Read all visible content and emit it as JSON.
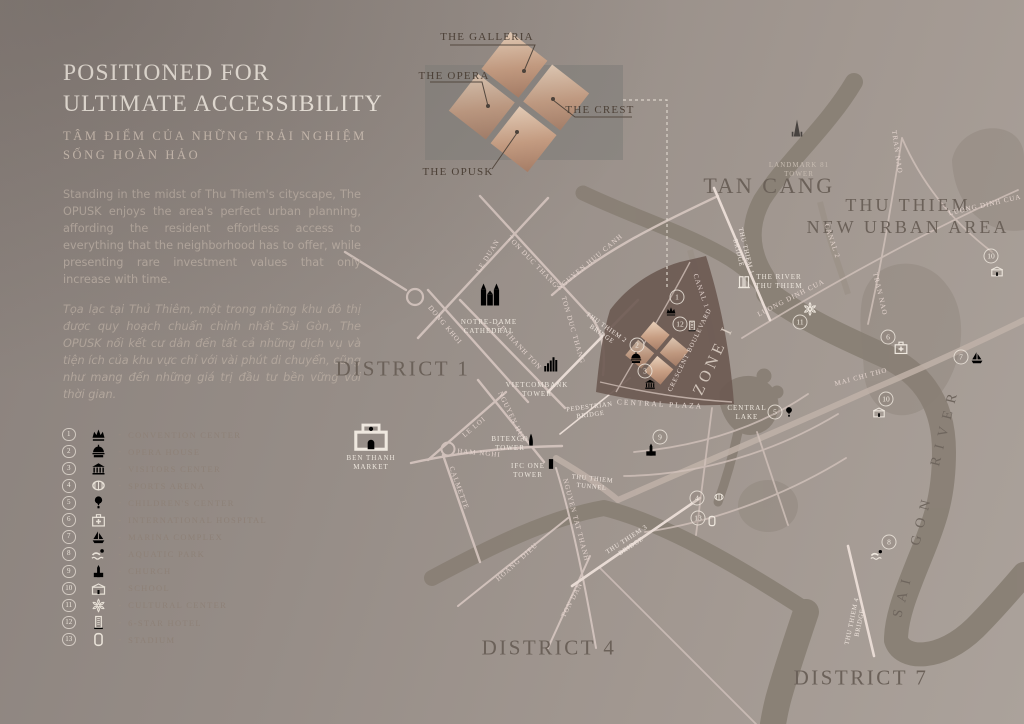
{
  "panel": {
    "title_line1": "POSITIONED FOR",
    "title_line2": "ULTIMATE ACCESSIBILITY",
    "subtitle_line1": "TÂM ĐIỂM CỦA NHỮNG TRẢI NGHIỆM",
    "subtitle_line2": "SỐNG HOÀN HẢO",
    "paragraph_en": "Standing in the midst of Thu Thiem's cityscape, The OPUSK enjoys the area's perfect urban planning, affording the resident effortless access to everything that the neighborhood has to offer, while presenting rare investment values that only increase with time.",
    "paragraph_vi": "Tọa lạc tại Thủ Thiêm, một trong những khu đô thị được quy hoạch chuẩn chỉnh nhất Sài Gòn, The OPUSK nối kết cư dân đến tất cả những dịch vụ và tiện ích của khu vực chỉ với vài phút di chuyển, cũng như mang đến những giá trị đầu tư bền vững với thời gian."
  },
  "inset": {
    "galleria": "THE GALLERIA",
    "opera": "THE OPERA",
    "crest": "THE CREST",
    "opusk": "THE OPUSK"
  },
  "legend": {
    "sep": "-",
    "items": [
      {
        "num": "1",
        "label": "CONVENTION CENTER"
      },
      {
        "num": "2",
        "label": "OPERA HOUSE"
      },
      {
        "num": "3",
        "label": "VISITORS CENTER"
      },
      {
        "num": "4",
        "label": "SPORTS ARENA"
      },
      {
        "num": "5",
        "label": "CHILDREN'S CENTER"
      },
      {
        "num": "6",
        "label": "INTERNATIONAL HOSPITAL"
      },
      {
        "num": "7",
        "label": "MARINA COMPLEX"
      },
      {
        "num": "8",
        "label": "AQUATIC PARK"
      },
      {
        "num": "9",
        "label": "CHURCH"
      },
      {
        "num": "10",
        "label": "SCHOOL"
      },
      {
        "num": "11",
        "label": "CULTURAL CENTER"
      },
      {
        "num": "12",
        "label": "6-STAR HOTEL"
      },
      {
        "num": "13",
        "label": "STADIUM"
      }
    ]
  },
  "map": {
    "districts": [
      "DISTRICT 1",
      "DISTRICT 4",
      "DISTRICT 7"
    ],
    "tan_cang": "TAN CANG",
    "thu_thiem_line1": "THU THIEM",
    "thu_thiem_line2": "NEW URBAN AREA",
    "sai_gon_river": "SAI GON RIVER",
    "zone": "ZONE I",
    "crescent_blvd": "CRESCENT BOULEVARD",
    "central_plaza": "CENTRAL PLAZA",
    "streets": [
      "LE DUAN",
      "TON DUC THANG",
      "NGUYEN HUU CANH",
      "DONG KHOI",
      "LE THANH TON",
      "TON DUC THANG",
      "NGUYEN HUE",
      "LE LOI",
      "HAM NGHI",
      "CALMETTE",
      "NGUYEN TAT THANH",
      "HOANG DIEU",
      "TON DAN",
      "MAI CHI THO",
      "LUONG DINH CUA",
      "LUONG DINH CUA",
      "TRAN NAO",
      "TRAN NAO",
      "CANAL 1",
      "CANAL 2"
    ],
    "bridges": [
      {
        "l1": "THU THIEM 2",
        "l2": "BRIDGE"
      },
      {
        "l1": "PEDESTRIAN",
        "l2": "BRIDGE"
      },
      {
        "l1": "THU THIEM 1",
        "l2": "BRIDGE"
      },
      {
        "l1": "THU THIEM 3",
        "l2": "BRIDGE"
      },
      {
        "l1": "THU THIEM 4",
        "l2": "BRIDGE"
      },
      {
        "l1": "THU THIEM",
        "l2": "TUNNEL"
      }
    ],
    "places": {
      "notre_dame": {
        "l1": "NOTRE-DAME",
        "l2": "CATHEDRAL"
      },
      "vietcombank": {
        "l1": "VIETCOMBANK",
        "l2": "TOWER"
      },
      "ben_thanh": {
        "l1": "BEN THANH",
        "l2": "MARKET"
      },
      "bitexco": {
        "l1": "BITEXCO",
        "l2": "TOWER"
      },
      "ifc": {
        "l1": "IFC ONE",
        "l2": "TOWER"
      },
      "landmark": {
        "l1": "LANDMARK 81",
        "l2": "TOWER"
      },
      "river_tt": {
        "l1": "THE RIVER",
        "l2": "THU THIEM"
      },
      "central_lake": {
        "l1": "CENTRAL",
        "l2": "LAKE"
      }
    },
    "markers": [
      "1",
      "2",
      "3",
      "4",
      "5",
      "6",
      "7",
      "8",
      "9",
      "10",
      "10",
      "11",
      "12",
      "13"
    ]
  },
  "colors": {
    "background": "#968d87",
    "zone_brown": "#6d5a52",
    "copper": "#c79e83",
    "river": "#8a8076",
    "road": "#d6c6c0",
    "ink": "#6b6159",
    "ivory": "#f2ebe2"
  }
}
